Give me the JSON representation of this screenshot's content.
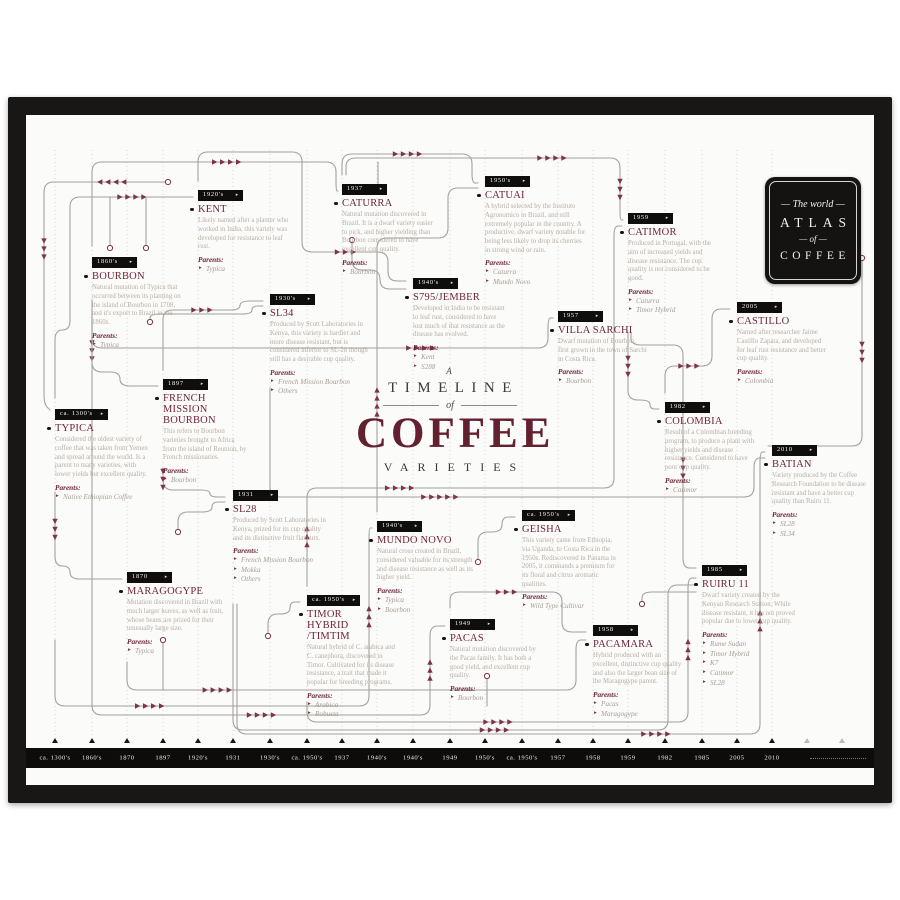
{
  "poster": {
    "title": {
      "prefix": "A",
      "line1": "TIMELINE",
      "of": "of",
      "main": "COFFEE",
      "line2": "VARIETIES"
    },
    "badge": {
      "line1": "The world",
      "line2": "ATLAS",
      "line3": "of",
      "line4": "COFFEE"
    },
    "parents_label": "Parents:",
    "year_arrow": "▸",
    "colors": {
      "maroon": "#6e2438",
      "arrow": "#7d3448",
      "muted_text": "#b9aea6",
      "line": "#a6a29e",
      "black": "#141312",
      "paper": "#fbfbf9"
    },
    "nodes": [
      {
        "id": "typica",
        "year": "ca. 1300's",
        "name_lines": [
          "TYPICA"
        ],
        "desc": "Considered the oldest variety of coffee that was taken from Yemen and spread around the world. Is a parent to many varieties, with lower yields but excellent quality.",
        "parents": [
          "Native Ethiopian Coffee"
        ]
      },
      {
        "id": "bourbon",
        "year": "1860's",
        "name_lines": [
          "BOURBON"
        ],
        "desc": "Natural mutation of Typica that occurred between its planting on the island of Bourbon in 1708, and it's export to Brazil in the 1860s.",
        "parents": [
          "Typica"
        ]
      },
      {
        "id": "maragogype",
        "year": "1870",
        "name_lines": [
          "MARAGOGYPE"
        ],
        "desc": "Mutation discovered in Brazil with much larger leaves, as well as fruit, whose beans are prized for their unusually large size.",
        "parents": [
          "Typica"
        ]
      },
      {
        "id": "fmb",
        "year": "1897",
        "name_lines": [
          "FRENCH",
          "MISSION",
          "BOURBON"
        ],
        "desc": "This refers to Bourbon varieties brought to Africa from the island of Reunion, by French missionaries.",
        "parents": [
          "Bourbon"
        ]
      },
      {
        "id": "kent",
        "year": "1920's",
        "name_lines": [
          "KENT"
        ],
        "desc": "Likely named after a planter who worked in India, this variety was developed for resistance to leaf rust.",
        "parents": [
          "Typica"
        ]
      },
      {
        "id": "sl28",
        "year": "1931",
        "name_lines": [
          "SL28"
        ],
        "desc": "Produced by Scott Laboratories in Kenya, prized for its cup quality and its distinctive fruit flavours.",
        "parents": [
          "French Mission Bourbon",
          "Mokka",
          "Others"
        ]
      },
      {
        "id": "sl34",
        "year": "1930's",
        "name_lines": [
          "SL34"
        ],
        "desc": "Produced by Scott Laboratories in Kenya, this variety is hardier and more disease resistant, but is considered inferior to SL-28 though still has a desirable cup quality.",
        "parents": [
          "French Mission Bourbon",
          "Others"
        ]
      },
      {
        "id": "timor",
        "year": "ca. 1950's",
        "name_lines": [
          "TIMOR",
          "HYBRID",
          "/TIMTIM"
        ],
        "desc": "Natural hybrid of C. arabica and C. canephora, discovered in Timor. Cultivated for its disease resistance, a trait that made it popular for breeding programs.",
        "parents": [
          "Arabica",
          "Robusta"
        ]
      },
      {
        "id": "caturra",
        "year": "1937",
        "name_lines": [
          "CATURRA"
        ],
        "desc": "Natural mutation discovered in Brazil. It is a dwarf variety easier to pick, and higher yielding than Bourbon considered to have excellent cup quality.",
        "parents": [
          "Bourbon"
        ]
      },
      {
        "id": "mundonovo",
        "year": "1940's",
        "name_lines": [
          "MUNDO NOVO"
        ],
        "desc": "Natural cross created in Brazil, considered valuable for its strength and disease resistance as well as its higher yield.",
        "parents": [
          "Typica",
          "Bourbon"
        ]
      },
      {
        "id": "s795",
        "year": "1940's",
        "name_lines": [
          "S795/JEMBER"
        ],
        "desc": "Developed in India to be resistant to leaf rust, considered to have lost much of that resistance as the disease has evolved.",
        "parents": [
          "Kent",
          "S288"
        ]
      },
      {
        "id": "pacas",
        "year": "1949",
        "name_lines": [
          "PACAS"
        ],
        "desc": "Natural mutation discovered by the Pacas family. It has both a good yield, and excellent cup quality.",
        "parents": [
          "Bourbon"
        ]
      },
      {
        "id": "catuai",
        "year": "1950's",
        "name_lines": [
          "CATUAI"
        ],
        "desc": "A hybrid selected by the Instituto Agronomico in Brazil, and still extremely popular in the country. A productive, dwarf variety notable for being less likely to drop its cherries in strong wind or rain.",
        "parents": [
          "Caturra",
          "Mundo Novo"
        ]
      },
      {
        "id": "geisha",
        "year": "ca. 1950's",
        "name_lines": [
          "GEISHA"
        ],
        "desc": "This variety came from Ethiopia, via Uganda, to Costa Rica in the 1950s. Rediscovered in Panama in 2005, it commands a premium for its floral and citrus aromatic qualities.",
        "parents": [
          "Wild Type Cultivar"
        ]
      },
      {
        "id": "villasarchi",
        "year": "1957",
        "name_lines": [
          "VILLA SARCHI"
        ],
        "desc": "Dwarf mutation of Bourbon, first grown in the town of Sarchi in Costa Rica.",
        "parents": [
          "Bourbon"
        ]
      },
      {
        "id": "pacamara",
        "year": "1958",
        "name_lines": [
          "PACAMARA"
        ],
        "desc": "Hybrid produced with an excellent, distinctive cup quality and also the larger bean size of the Maragogype parent.",
        "parents": [
          "Pacas",
          "Maragogype"
        ]
      },
      {
        "id": "catimor",
        "year": "1959",
        "name_lines": [
          "CATIMOR"
        ],
        "desc": "Produced in Portugal, with the aim of increased yields and disease resistance. The cup quality is not considered to be good.",
        "parents": [
          "Caturra",
          "Timor Hybrid"
        ]
      },
      {
        "id": "colombia",
        "year": "1982",
        "name_lines": [
          "COLOMBIA"
        ],
        "desc": "Result of a Colombian breeding program, to produce a plant with higher yields and disease resistance. Considered to have poor cup quality.",
        "parents": [
          "Catimor"
        ]
      },
      {
        "id": "ruiru11",
        "year": "1985",
        "name_lines": [
          "RUIRU 11"
        ],
        "desc": "Dwarf variety created by the Kenyan Research Station. While disease resistant, it has not proved popular due to lower cup quality.",
        "parents": [
          "Rume Sudan",
          "Timor Hybrid",
          "K7",
          "Catimor",
          "SL28"
        ]
      },
      {
        "id": "castillo",
        "year": "2005",
        "name_lines": [
          "CASTILLO"
        ],
        "desc": "Named after researcher Jaime Castillo Zapata, and developed for leaf rust resistance and better cup quality.",
        "parents": [
          "Colombia"
        ]
      },
      {
        "id": "batian",
        "year": "2010",
        "name_lines": [
          "BATIAN"
        ],
        "desc": "Variety produced by the Coffee Research Foundation to be disease resistant and have a better cup quality than Ruiru 11.",
        "parents": [
          "SL28",
          "SL34"
        ]
      }
    ],
    "timeline": {
      "labels": [
        "ca. 1300's",
        "1860's",
        "1870",
        "1897",
        "1920's",
        "1931",
        "1930's",
        "ca. 1950's",
        "1937",
        "1940's",
        "1940's",
        "1949",
        "1950's",
        "ca. 1950's",
        "1957",
        "1958",
        "1959",
        "1982",
        "1985",
        "2005",
        "2010"
      ]
    }
  }
}
